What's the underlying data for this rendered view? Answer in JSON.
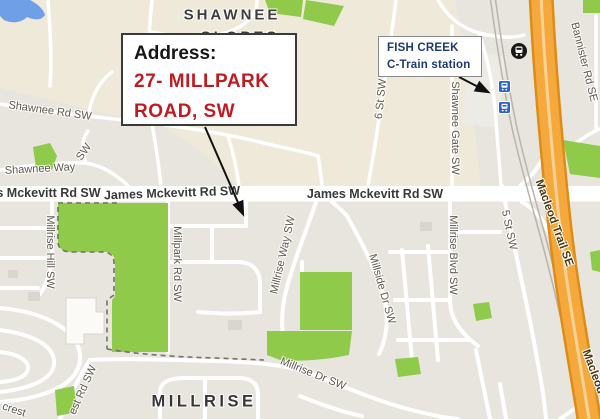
{
  "map": {
    "neighborhoods": {
      "shawnee_line1": "SHAWNEE",
      "shawnee_line2": "SLOPES",
      "millrise": "MILLRISE"
    },
    "road_labels": {
      "shawnee_rd": "Shawnee Rd SW",
      "shawnee_way": "Shawnee Way",
      "shawnee_way_sw": "SW",
      "jm_left": "es Mckevitt Rd SW",
      "jm_center": "James Mckevitt Rd SW",
      "jm_right": "James Mckevitt Rd SW",
      "six_st": "6 St SW",
      "shawnee_gate": "Shawnee Gate SW",
      "bannister": "Bannister Rd SE",
      "macleod": "Macleod Trail SE",
      "millrise_hill": "Millrise Hill SW",
      "millpark_rd": "Millpark Rd SW",
      "millrise_way": "Millrise Way SW",
      "millside_dr": "Millside Dr SW",
      "millrise_blvd": "Millrise Blvd SW",
      "five_st": "5 St SW",
      "millrise_dr": "Millrise Dr SW",
      "crest_partial": "crest",
      "est_rd_partial": "est Rd SW"
    }
  },
  "annotations": {
    "address_box": {
      "title": "Address:",
      "line1": "27- MILLPARK",
      "line2": "ROAD, SW",
      "text_color": "#c11b22"
    },
    "station_box": {
      "line1": "FISH CREEK",
      "line2": "C-Train station",
      "text_color": "#1c3a75"
    }
  },
  "icons": {
    "ctrain_station_upper": "ctrain-station-icon",
    "ctrain_station_lower": "ctrain-station-icon",
    "transit_hub": "transit-hub-circle-icon"
  },
  "colors": {
    "park_green": "#8fca4a",
    "highway_orange": "#f5a93d",
    "highway_casing": "#dd8d16",
    "water_blue": "#6f9fe6",
    "terrain_tan": "#efe9d9",
    "urban_gray": "#e8e5df",
    "address_red": "#c11b22",
    "station_navy": "#1c3a75"
  }
}
